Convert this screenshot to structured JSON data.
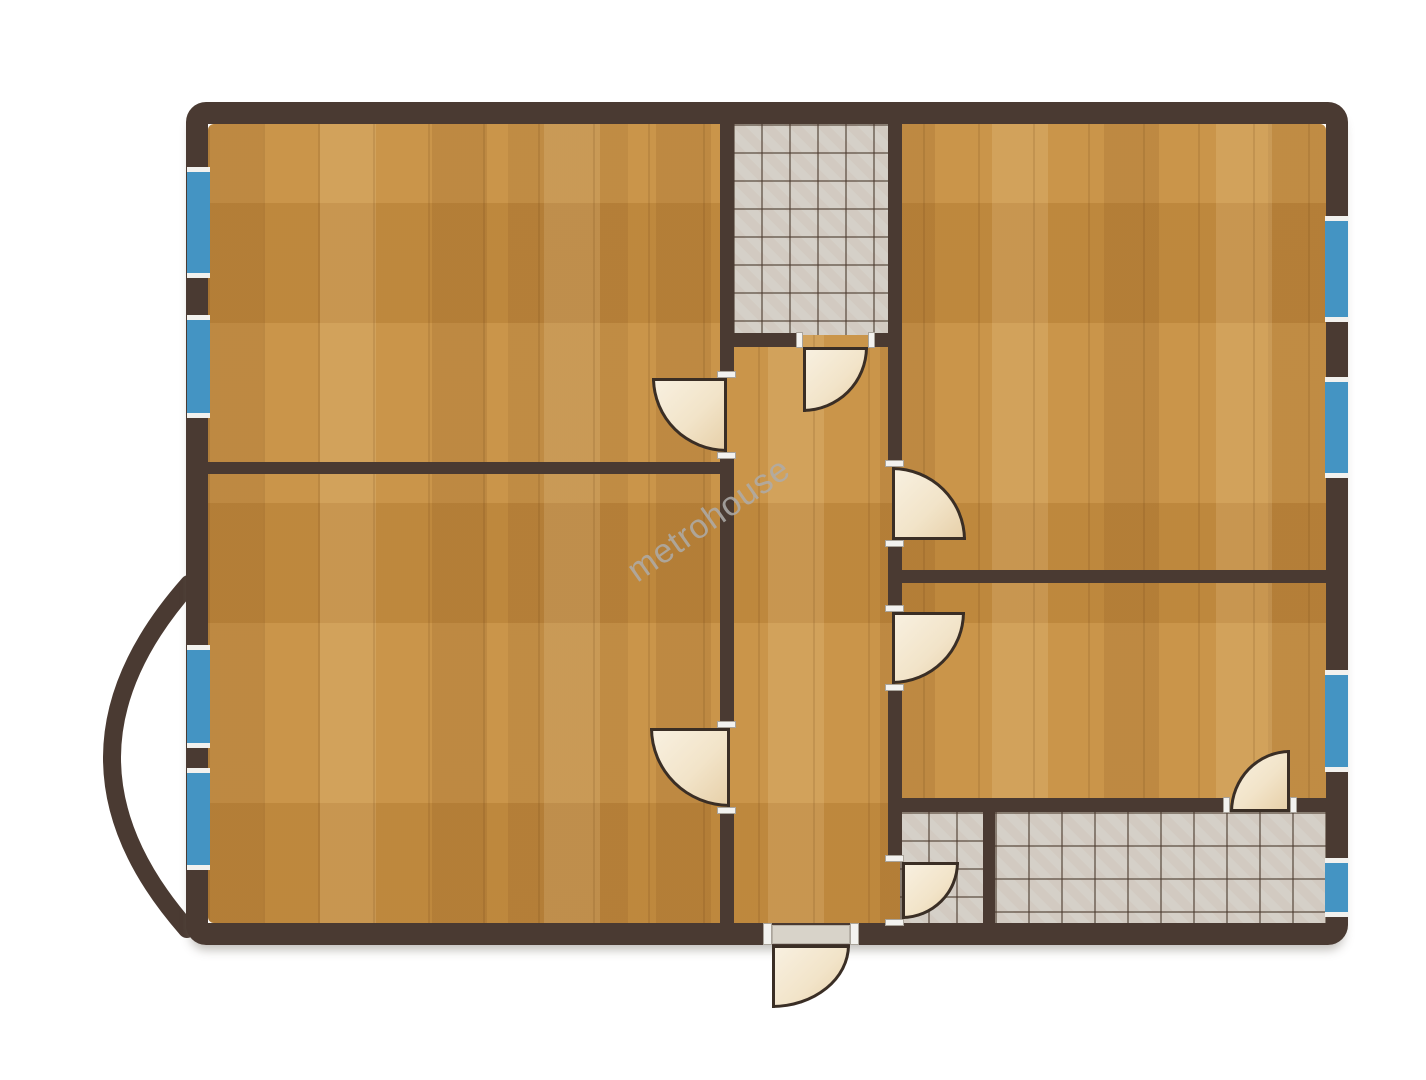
{
  "meta": {
    "watermark": "metrohouse",
    "drawing_type": "apartment-floor-plan"
  },
  "palette": {
    "wall": "#4a3a32",
    "wood_floor": "#c68f42",
    "tile_floor": "#d5d0c8",
    "window_glass": "#4494c3",
    "window_frame": "#f2f1ee",
    "door_leaf": "#f2e4c9",
    "door_outline": "#3a2e25",
    "watermark_gray": "#aeacaa",
    "background": "#ffffff"
  },
  "plan": {
    "outer_wall": {
      "name": "outer-wall",
      "x": 186,
      "y": 102,
      "w": 1162,
      "h": 843,
      "thickness": 22
    },
    "balcony": {
      "name": "balcony-arc",
      "path": "M 189 584 Q 36 757 187 929"
    },
    "floors": [
      {
        "name": "floor-tiles-wc",
        "x": 733,
        "y": 124,
        "w": 156,
        "h": 211,
        "tile": 28
      },
      {
        "name": "floor-tiles-bathroom-small",
        "x": 900,
        "y": 812,
        "w": 84,
        "h": 112,
        "tile": 28
      },
      {
        "name": "floor-tiles-bathroom-large",
        "x": 995,
        "y": 812,
        "w": 331,
        "h": 112,
        "tile": 33
      }
    ],
    "walls": [
      {
        "name": "wall-hall-west-upper",
        "x": 720,
        "y": 124,
        "w": 14,
        "h": 248
      },
      {
        "name": "wall-hall-west-mid",
        "x": 720,
        "y": 458,
        "w": 14,
        "h": 264
      },
      {
        "name": "wall-hall-west-lower",
        "x": 720,
        "y": 812,
        "w": 14,
        "h": 113
      },
      {
        "name": "wall-divider-left-rooms",
        "x": 208,
        "y": 462,
        "w": 525,
        "h": 12
      },
      {
        "name": "wall-wc-south-left",
        "x": 720,
        "y": 333,
        "w": 83,
        "h": 14
      },
      {
        "name": "wall-wc-south-right",
        "x": 872,
        "y": 333,
        "w": 30,
        "h": 14
      },
      {
        "name": "wall-hall-east-upper",
        "x": 888,
        "y": 124,
        "w": 14,
        "h": 336
      },
      {
        "name": "wall-hall-east-mid",
        "x": 888,
        "y": 547,
        "w": 14,
        "h": 58
      },
      {
        "name": "wall-hall-east-lower",
        "x": 888,
        "y": 691,
        "w": 14,
        "h": 164
      },
      {
        "name": "wall-divider-right-rooms",
        "x": 902,
        "y": 570,
        "w": 424,
        "h": 13
      },
      {
        "name": "wall-bathrooms-north-left",
        "x": 888,
        "y": 798,
        "w": 342,
        "h": 14
      },
      {
        "name": "wall-bathrooms-north-right",
        "x": 1290,
        "y": 798,
        "w": 36,
        "h": 14
      },
      {
        "name": "wall-bathrooms-divider",
        "x": 983,
        "y": 812,
        "w": 12,
        "h": 113
      }
    ],
    "windows": [
      {
        "name": "window-left-1",
        "x": 187,
        "y": 167,
        "w": 23,
        "h": 111
      },
      {
        "name": "window-left-2",
        "x": 187,
        "y": 315,
        "w": 23,
        "h": 103
      },
      {
        "name": "window-left-3",
        "x": 187,
        "y": 645,
        "w": 23,
        "h": 103
      },
      {
        "name": "window-left-4",
        "x": 187,
        "y": 768,
        "w": 23,
        "h": 102
      },
      {
        "name": "window-right-1",
        "x": 1325,
        "y": 216,
        "w": 23,
        "h": 106
      },
      {
        "name": "window-right-2",
        "x": 1325,
        "y": 377,
        "w": 23,
        "h": 101
      },
      {
        "name": "window-right-3",
        "x": 1325,
        "y": 670,
        "w": 23,
        "h": 102
      },
      {
        "name": "window-right-4",
        "x": 1325,
        "y": 858,
        "w": 23,
        "h": 59
      }
    ],
    "doors": [
      {
        "name": "door-wc",
        "x": 803,
        "y": 347,
        "w": 65,
        "h": 65,
        "corner": "br"
      },
      {
        "name": "door-room-top-left",
        "x": 652,
        "y": 378,
        "w": 75,
        "h": 74,
        "corner": "bl"
      },
      {
        "name": "door-room-top-right",
        "x": 892,
        "y": 467,
        "w": 74,
        "h": 73,
        "corner": "tr"
      },
      {
        "name": "door-room-bottom-right",
        "x": 892,
        "y": 612,
        "w": 73,
        "h": 72,
        "corner": "br"
      },
      {
        "name": "door-bathroom-large",
        "x": 1230,
        "y": 750,
        "w": 60,
        "h": 62,
        "corner": "tl"
      },
      {
        "name": "door-bathroom-small",
        "x": 902,
        "y": 862,
        "w": 57,
        "h": 57,
        "corner": "br"
      },
      {
        "name": "door-room-bottom-left",
        "x": 650,
        "y": 728,
        "w": 80,
        "h": 79,
        "corner": "bl"
      },
      {
        "name": "door-entrance",
        "x": 772,
        "y": 945,
        "w": 78,
        "h": 63,
        "corner": "br"
      }
    ],
    "jambs": [
      {
        "name": "jamb-room-top-left-a",
        "x": 717,
        "y": 371,
        "w": 19,
        "h": 7
      },
      {
        "name": "jamb-room-top-left-b",
        "x": 717,
        "y": 452,
        "w": 19,
        "h": 7
      },
      {
        "name": "jamb-room-bottom-left-a",
        "x": 717,
        "y": 721,
        "w": 19,
        "h": 7
      },
      {
        "name": "jamb-room-bottom-left-b",
        "x": 717,
        "y": 807,
        "w": 19,
        "h": 7
      },
      {
        "name": "jamb-room-top-right-a",
        "x": 885,
        "y": 460,
        "w": 19,
        "h": 7
      },
      {
        "name": "jamb-room-top-right-b",
        "x": 885,
        "y": 540,
        "w": 19,
        "h": 7
      },
      {
        "name": "jamb-room-bottom-right-a",
        "x": 885,
        "y": 605,
        "w": 19,
        "h": 7
      },
      {
        "name": "jamb-room-bottom-right-b",
        "x": 885,
        "y": 684,
        "w": 19,
        "h": 7
      },
      {
        "name": "jamb-bathroom-small-a",
        "x": 885,
        "y": 855,
        "w": 19,
        "h": 7
      },
      {
        "name": "jamb-bathroom-small-b",
        "x": 885,
        "y": 919,
        "w": 19,
        "h": 7
      },
      {
        "name": "jamb-wc-a",
        "x": 796,
        "y": 332,
        "w": 7,
        "h": 16
      },
      {
        "name": "jamb-wc-b",
        "x": 868,
        "y": 332,
        "w": 7,
        "h": 16
      },
      {
        "name": "jamb-bathroom-large-a",
        "x": 1223,
        "y": 797,
        "w": 7,
        "h": 16
      },
      {
        "name": "jamb-bathroom-large-b",
        "x": 1290,
        "y": 797,
        "w": 7,
        "h": 16
      },
      {
        "name": "jamb-entrance-a",
        "x": 763,
        "y": 923,
        "w": 9,
        "h": 22
      },
      {
        "name": "jamb-entrance-b",
        "x": 850,
        "y": 923,
        "w": 9,
        "h": 22
      }
    ],
    "thresholds": [
      {
        "name": "entrance-threshold",
        "x": 772,
        "y": 925,
        "w": 78,
        "h": 19
      }
    ]
  }
}
